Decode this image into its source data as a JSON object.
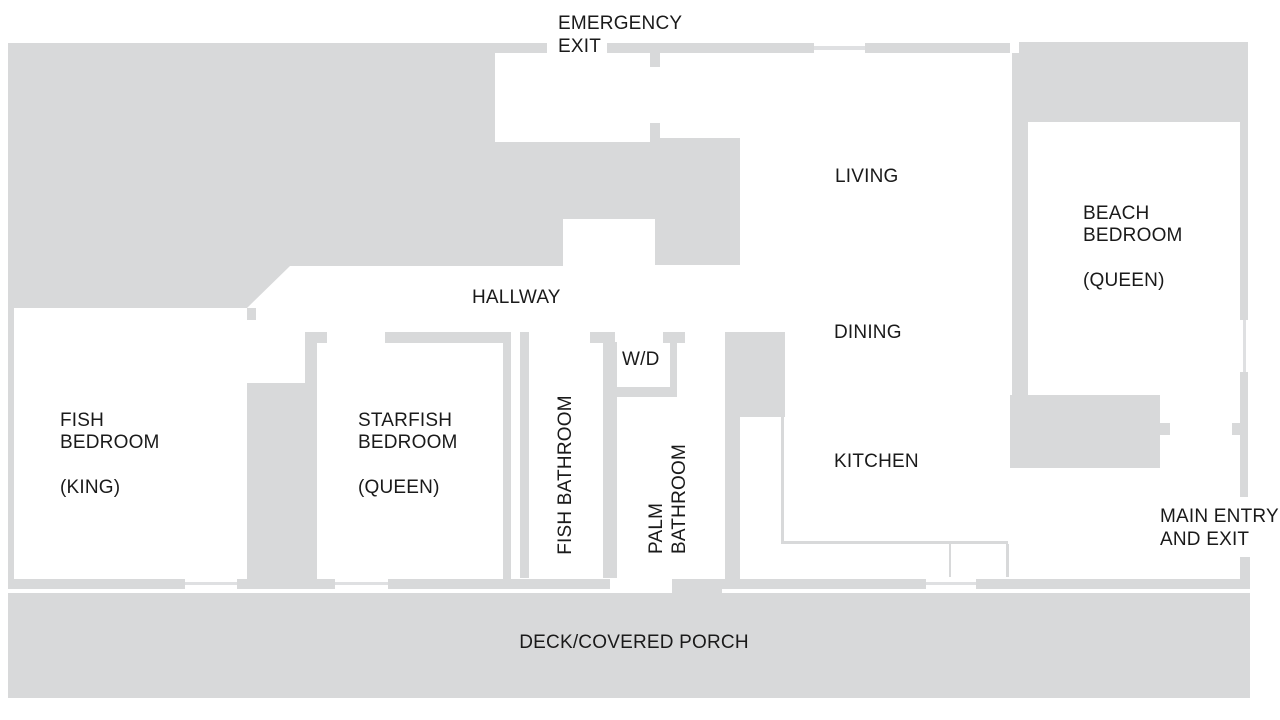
{
  "title": "Beach house floor plan",
  "colors": {
    "wall": "#d8d9da",
    "window_line": "#dfe0e2",
    "text": "#1a1a1a",
    "background": "#ffffff"
  },
  "labels": {
    "emergency_exit": {
      "line1": "EMERGENCY",
      "line2": "EXIT"
    },
    "living": "LIVING",
    "dining": "DINING",
    "kitchen": "KITCHEN",
    "hallway": "HALLWAY",
    "wd": "W/D",
    "fish_bedroom": {
      "line1": "FISH",
      "line2": "BEDROOM",
      "line3": "(KING)"
    },
    "starfish_bedroom": {
      "line1": "STARFISH",
      "line2": "BEDROOM",
      "line3": "(QUEEN)"
    },
    "beach_bedroom": {
      "line1": "BEACH",
      "line2": "BEDROOM",
      "line3": "(QUEEN)"
    },
    "fish_bathroom": "FISH BATHROOM",
    "palm_bathroom": {
      "line1": "PALM",
      "line2": "BATHROOM"
    },
    "main_entry": {
      "line1": "MAIN ENTRY",
      "line2": "AND EXIT"
    },
    "deck": "DECK/COVERED PORCH"
  }
}
